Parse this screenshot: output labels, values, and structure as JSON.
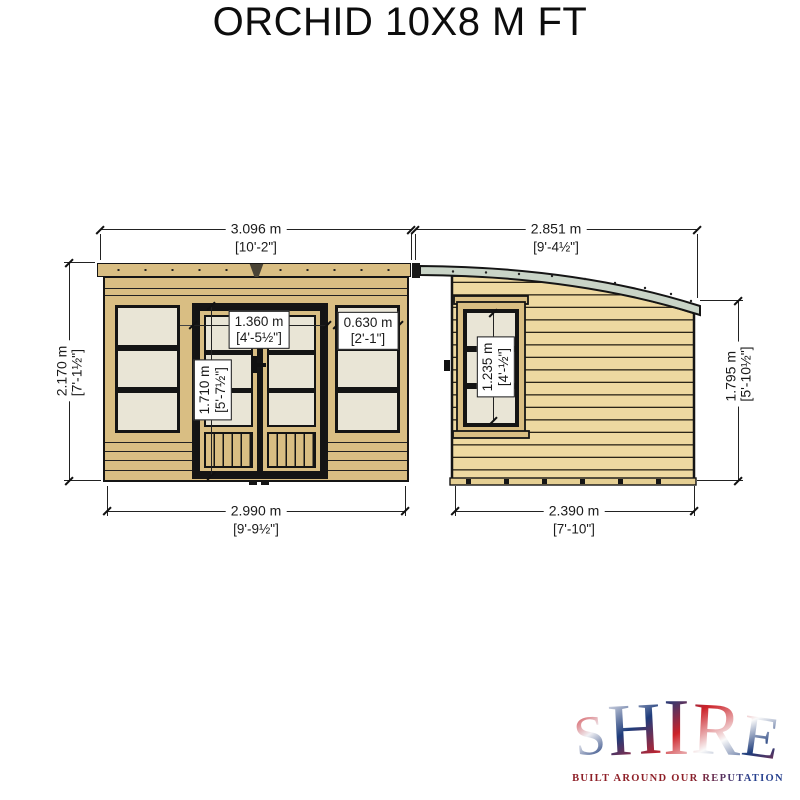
{
  "title": "ORCHID 10X8 M FT",
  "views": {
    "front": {
      "overall_width": {
        "m": "3.096 m",
        "ft": "[10'-2\"]"
      },
      "base_width": {
        "m": "2.990 m",
        "ft": "[9'-9½\"]"
      },
      "height": {
        "m": "2.170 m",
        "ft": "[7'-1½\"]"
      },
      "door_width": {
        "m": "1.360 m",
        "ft": "[4'-5½\"]"
      },
      "door_height": {
        "m": "1.710 m",
        "ft": "[5'-7½\"]"
      },
      "window_width": {
        "m": "0.630 m",
        "ft": "[2'-1\"]"
      }
    },
    "side": {
      "overall_width": {
        "m": "2.851 m",
        "ft": "[9'-4½\"]"
      },
      "base_width": {
        "m": "2.390 m",
        "ft": "[7'-10\"]"
      },
      "eaves_height": {
        "m": "1.795 m",
        "ft": "[5'-10½\"]"
      },
      "window_height": {
        "m": "1.235 m",
        "ft": "[4'-½\"]"
      }
    }
  },
  "brand": {
    "letters": [
      "S",
      "H",
      "I",
      "R",
      "E"
    ],
    "tagline": "BUILT AROUND OUR REPUTATION"
  },
  "colors": {
    "wood_front": "#d9be83",
    "wood_side": "#eed9a1",
    "window_pane": "#e9e5d6",
    "roof_trim": "#c9d4c7",
    "outline": "#151515",
    "dimension_line": "#222222",
    "brand_red": "#cc2229",
    "brand_blue": "#1e3c7b"
  }
}
